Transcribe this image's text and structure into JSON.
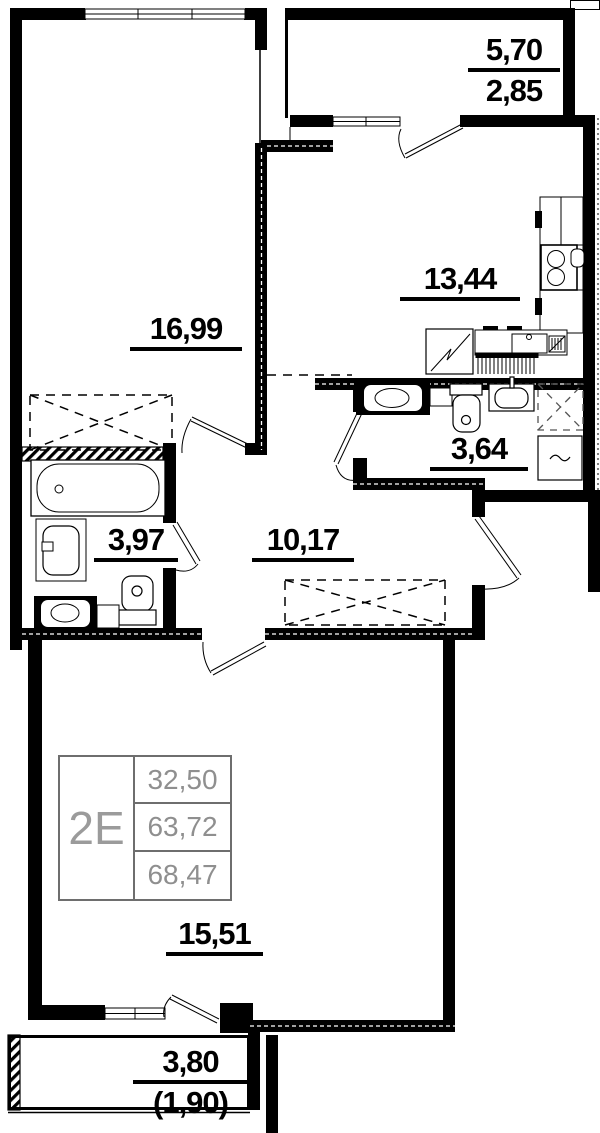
{
  "plan_title": "apartment-floor-plan",
  "areas": {
    "room_top": "16,99",
    "kitchen": "13,44",
    "wc": "3,64",
    "bathroom": "3,97",
    "hall": "10,17",
    "room_bottom": "15,51"
  },
  "balcony_top": {
    "total": "5,70",
    "reduced": "2,85"
  },
  "balcony_bottom": {
    "total": "3,80",
    "reduced": "(1,90)"
  },
  "legend": {
    "unit_type": "2E",
    "values": [
      "32,50",
      "63,72",
      "68,47"
    ]
  },
  "colors": {
    "wall": "#000000",
    "legend_text": "#8f8f8f",
    "legend_border": "#6e6e6e"
  }
}
